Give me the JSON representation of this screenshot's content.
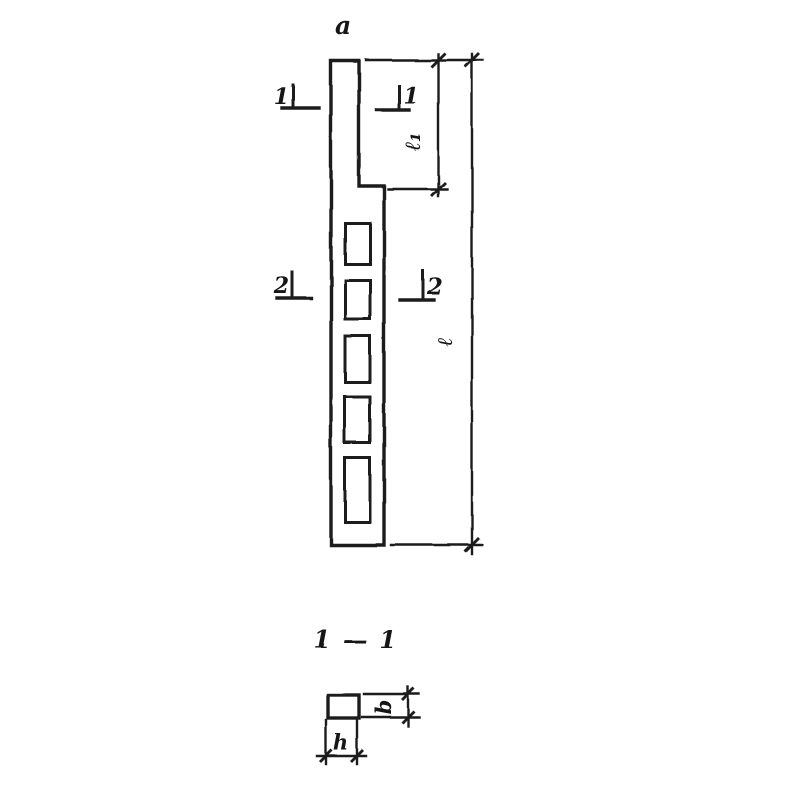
{
  "figure": {
    "view_label": "a",
    "section_title": "1 — 1"
  },
  "elevation": {
    "section_mark_1_left": "1",
    "section_mark_1_right": "1",
    "section_mark_2_left": "2",
    "section_mark_2_right": "2",
    "dim_top_length_label": "ℓ₁",
    "dim_total_length_label": "ℓ",
    "openings_count": 5
  },
  "cross_section": {
    "dim_depth_label": "b",
    "dim_width_label": "h"
  },
  "colors": {
    "ink": "#1b1b1b",
    "paper": "#ffffff"
  }
}
